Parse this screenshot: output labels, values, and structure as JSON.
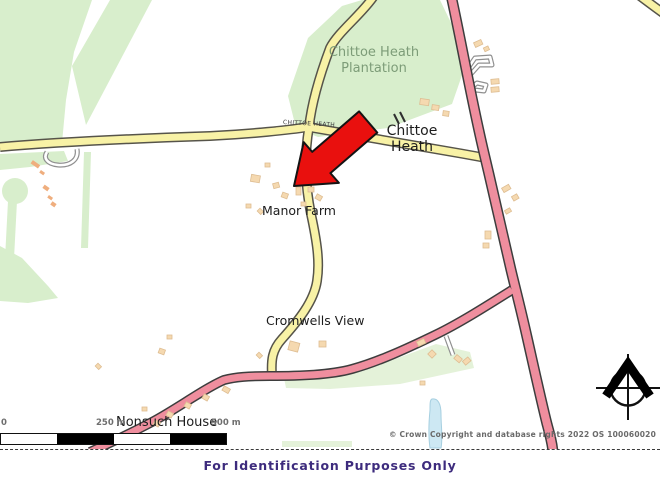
{
  "map": {
    "labels": {
      "plantation": {
        "line1": "Chittoe Heath",
        "line2": "Plantation"
      },
      "settlement": {
        "line1": "Chittoe",
        "line2": "Heath"
      },
      "manor_farm": "Manor Farm",
      "cromwells_view": "Cromwells View",
      "nonsuch_house": "Nonsuch House",
      "road_name": "CHITTOE HEATH"
    },
    "scale_bar": {
      "zero": "0",
      "middle": "250 m",
      "end": "500 m"
    },
    "copyright": "© Crown Copyright and database rights 2022 OS 100060020",
    "icons": {
      "north_arrow": "compass-north-arrow-icon",
      "marker": "red-location-arrow-icon"
    },
    "colors": {
      "map_green": "#d8eecc",
      "map_green_light": "#e4f2d9",
      "road_yellow_fill": "#f8f2a6",
      "road_yellow_casing": "#56544a",
      "road_pink_fill": "#ef8e9e",
      "road_pink_casing": "#3d3d3d",
      "road_minor_casing": "#909090",
      "building_fill": "#f5d9b0",
      "building_stroke": "#debd92",
      "building_orange": "#efae7e",
      "water_fill": "#cde8f3",
      "water_stroke": "#a6cfe0",
      "arrow_red": "#e9100e",
      "arrow_outline": "#141414",
      "label_black": "#1d1d1d",
      "label_green": "#7d9c78",
      "road_label_gray": "#3c3c3c",
      "scale_gray": "#6e6e6e",
      "copyright_gray": "#6a6a6a",
      "footer_purple": "#3d2b7d",
      "border_dash": "#3a3a3a"
    }
  },
  "footer": {
    "text": "For Identification Purposes Only"
  }
}
